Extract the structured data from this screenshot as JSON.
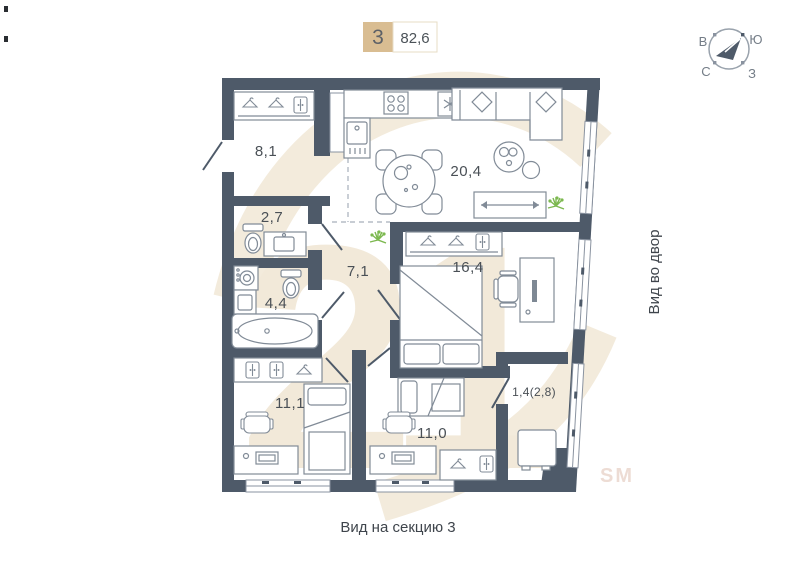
{
  "header": {
    "rooms_count": "3",
    "total_area": "82,6"
  },
  "compass": {
    "east": "В",
    "south": "Ю",
    "north": "С",
    "west": "З"
  },
  "plan": {
    "rooms": [
      {
        "name": "hallway",
        "area": "8,1"
      },
      {
        "name": "wc",
        "area": "2,7"
      },
      {
        "name": "bathroom",
        "area": "4,4"
      },
      {
        "name": "corridor",
        "area": "7,1"
      },
      {
        "name": "kitchen-living-room",
        "area": "20,4"
      },
      {
        "name": "bedroom-main",
        "area": "16,4"
      },
      {
        "name": "bedroom-second",
        "area": "11,1"
      },
      {
        "name": "bedroom-third",
        "area": "11,0"
      },
      {
        "name": "balcony",
        "area": "1,4(2,8)"
      }
    ]
  },
  "captions": {
    "bottom": "Вид на секцию 3",
    "right_side": "Вид во двор"
  },
  "watermark": {
    "big": "21",
    "small": "SM"
  },
  "colors": {
    "wall": "#4e5a69",
    "badge": "#d9bd92",
    "watermark": "#f2e9d9",
    "furniture_outline": "#818b97",
    "plant": "#7cb84f",
    "label_text": "#4a5056"
  },
  "icons": {
    "compass": "circle-with-needle",
    "hanger": "triangle-hanger",
    "cabinet": "two-door-cabinet",
    "stove": "four-burners",
    "fridge": "snowflake",
    "plant": "green-burst"
  }
}
